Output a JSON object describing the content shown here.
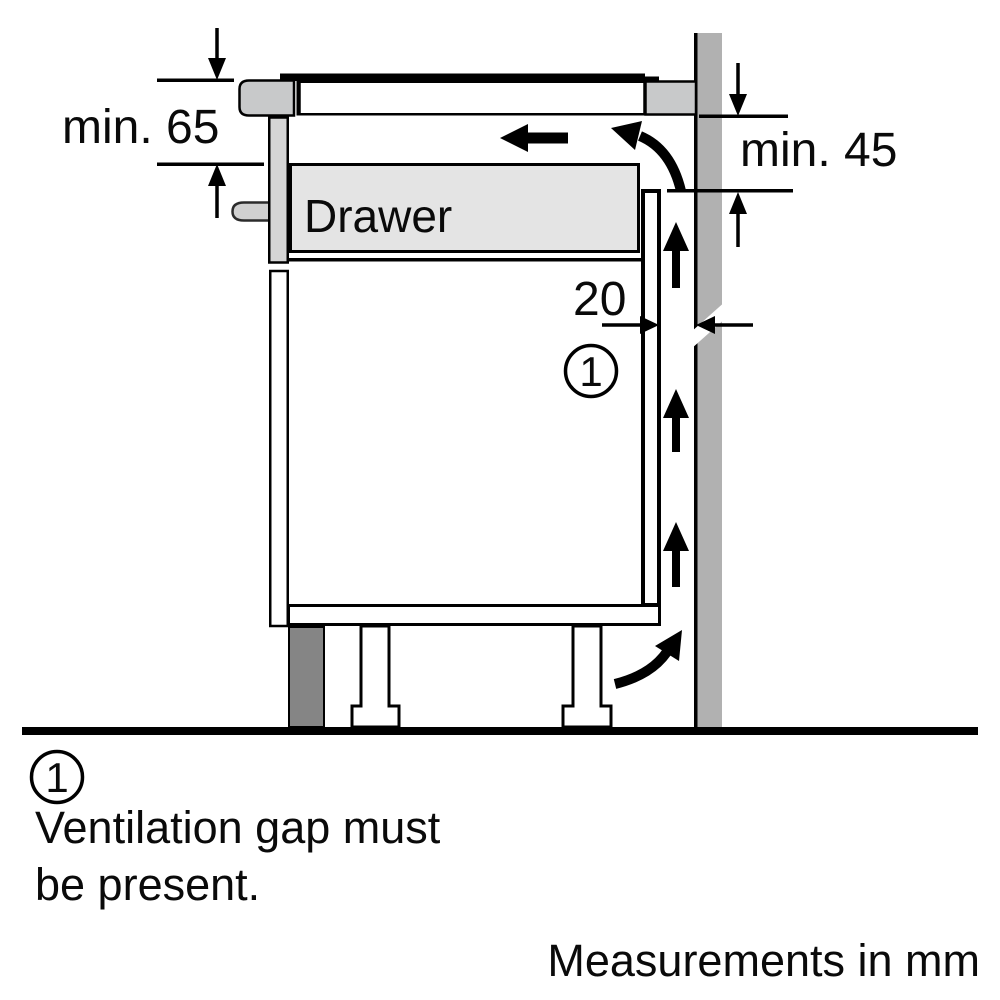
{
  "diagram": {
    "drawer_label": "Drawer",
    "dimensions": {
      "front_clearance": "min. 65",
      "rear_clearance": "min. 45",
      "ventilation_gap": "20"
    },
    "callout": "1"
  },
  "legend": {
    "number": "1",
    "line1": "Ventilation gap must",
    "line2": "be present.",
    "footer": "Measurements in mm"
  },
  "colors": {
    "wall": "#b1b1b1",
    "hob_body": "#c8c9ca",
    "worktop": "#ffffff",
    "drawer_front": "#d5d5d5",
    "drawer_box": "#e4e4e4",
    "handle": "#d0d0d0",
    "plinth": "#858585",
    "line": "#000000"
  }
}
